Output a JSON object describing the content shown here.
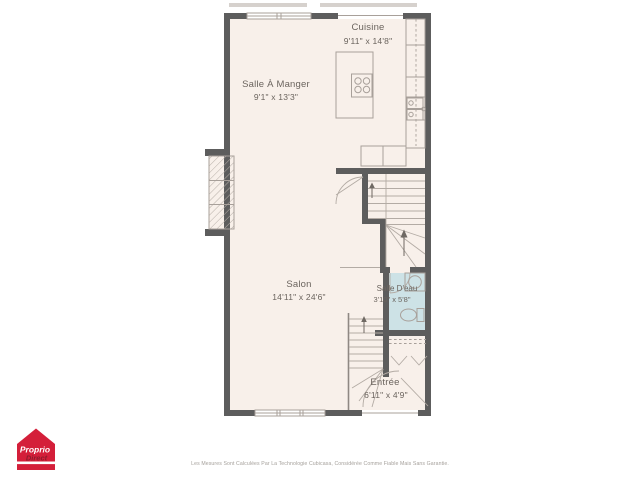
{
  "colors": {
    "floor": "#f8f0ea",
    "wall": "#5d5d5d",
    "line": "#a8a09a",
    "bathroom_fill": "#cde2e6",
    "label_text": "#6b645e",
    "deck": "#d6d1cd",
    "logo_red": "#d41f3a",
    "logo_text_dark": "#8c1c2c",
    "disclaimer_text": "#a5a09b"
  },
  "rooms": {
    "cuisine": {
      "name": "Cuisine",
      "dims": "9'11\" x 14'8\""
    },
    "salle_a_manger": {
      "name": "Salle À Manger",
      "dims": "9'1\" x 13'3\""
    },
    "salon": {
      "name": "Salon",
      "dims": "14'11\" x 24'6\""
    },
    "salle_deau": {
      "name": "Salle D'eau",
      "dims": "3'10\" x 5'8\""
    },
    "entree": {
      "name": "Entrée",
      "dims": "6'11\" x 4'9\""
    }
  },
  "logo": {
    "line1": "Proprio",
    "line2": "Direct"
  },
  "disclaimer": "Les Mesures Sont Calculées Par La Technologie Cubicasa, Considérée Comme Fiable Mais Sans Garantie."
}
